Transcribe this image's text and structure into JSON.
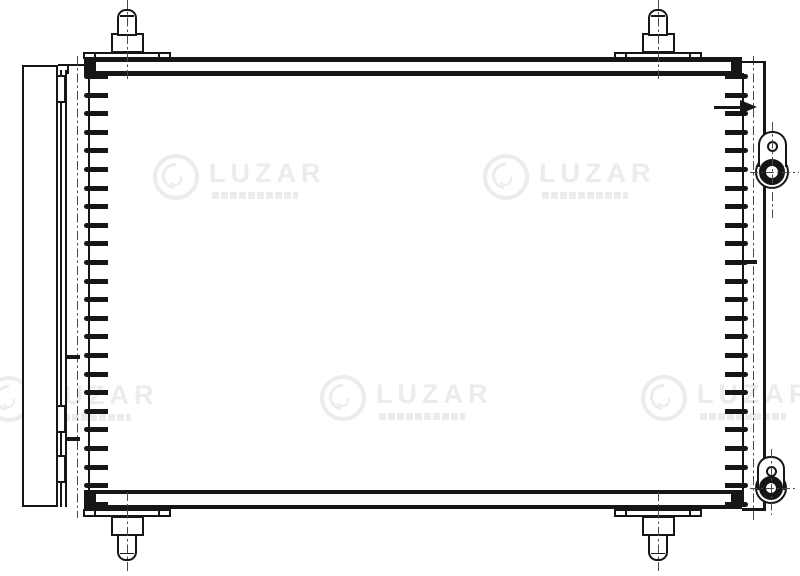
{
  "page": {
    "background": "#ffffff"
  },
  "drawing": {
    "ink_color": "#161616",
    "centerline_color": "#4a4a4a"
  },
  "watermark": {
    "brand": "LUZAR",
    "color": "#ececec",
    "count": 5
  }
}
